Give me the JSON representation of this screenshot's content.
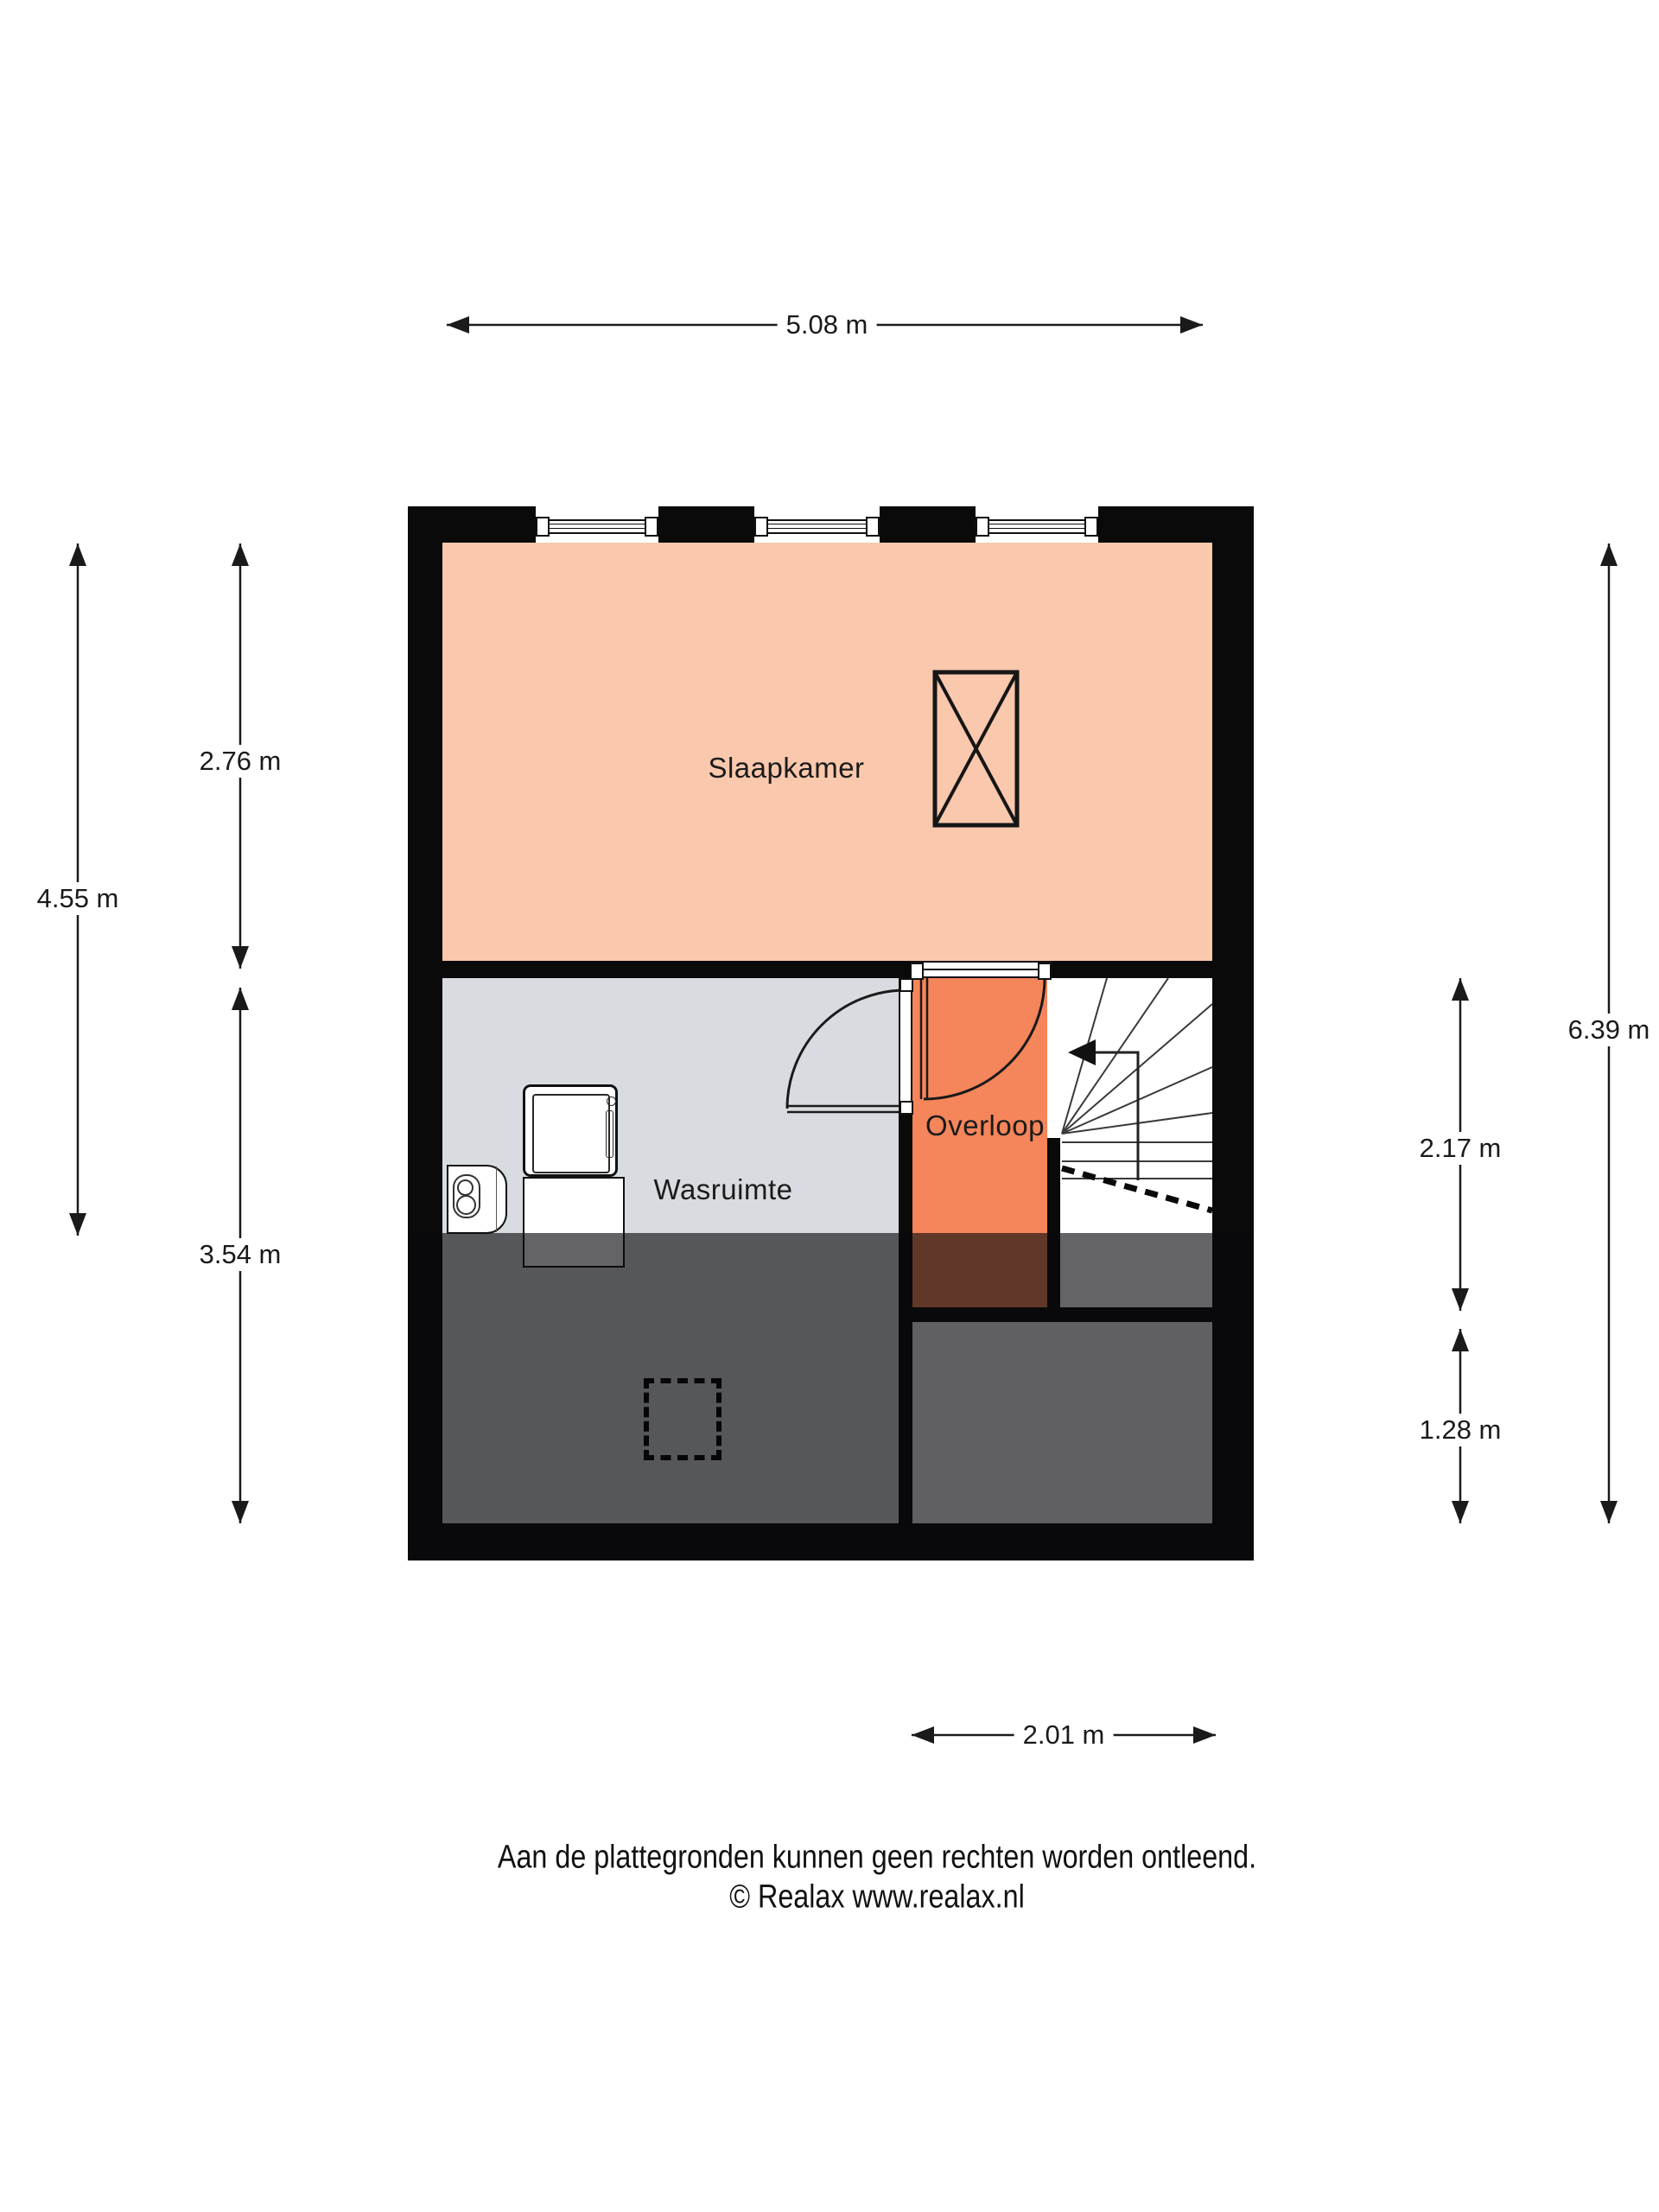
{
  "rooms": {
    "slaapkamer": "Slaapkamer",
    "wasruimte": "Wasruimte",
    "overloop": "Overloop"
  },
  "dimensions": {
    "top": "5.08 m",
    "left_outer": "4.55 m",
    "left_top": "2.76 m",
    "left_bottom": "3.54 m",
    "right_outer": "6.39 m",
    "right_top": "2.17 m",
    "right_bottom": "1.28 m",
    "bottom": "2.01 m"
  },
  "footer": {
    "line1": "Aan de plattegronden kunnen geen rechten worden ontleend.",
    "line2": "© Realax www.realax.nl"
  },
  "symbols": [
    "washing-machine-icon",
    "laundry-basket-icon",
    "boiler-icon",
    "roof-window-icon",
    "staircase-icon",
    "door-swing-icon",
    "loft-hatch-icon"
  ],
  "colors": {
    "bedroom": "#f9c8ad",
    "landing": "#f5855a",
    "laundry": "#d8dce0",
    "stairwell": "#ffffff",
    "bottom-room": "#f4f4f4",
    "wall": "#0a0a0a",
    "line": "#1a1a1a",
    "dark-overlay": "rgba(10,10,12,0.63)"
  }
}
